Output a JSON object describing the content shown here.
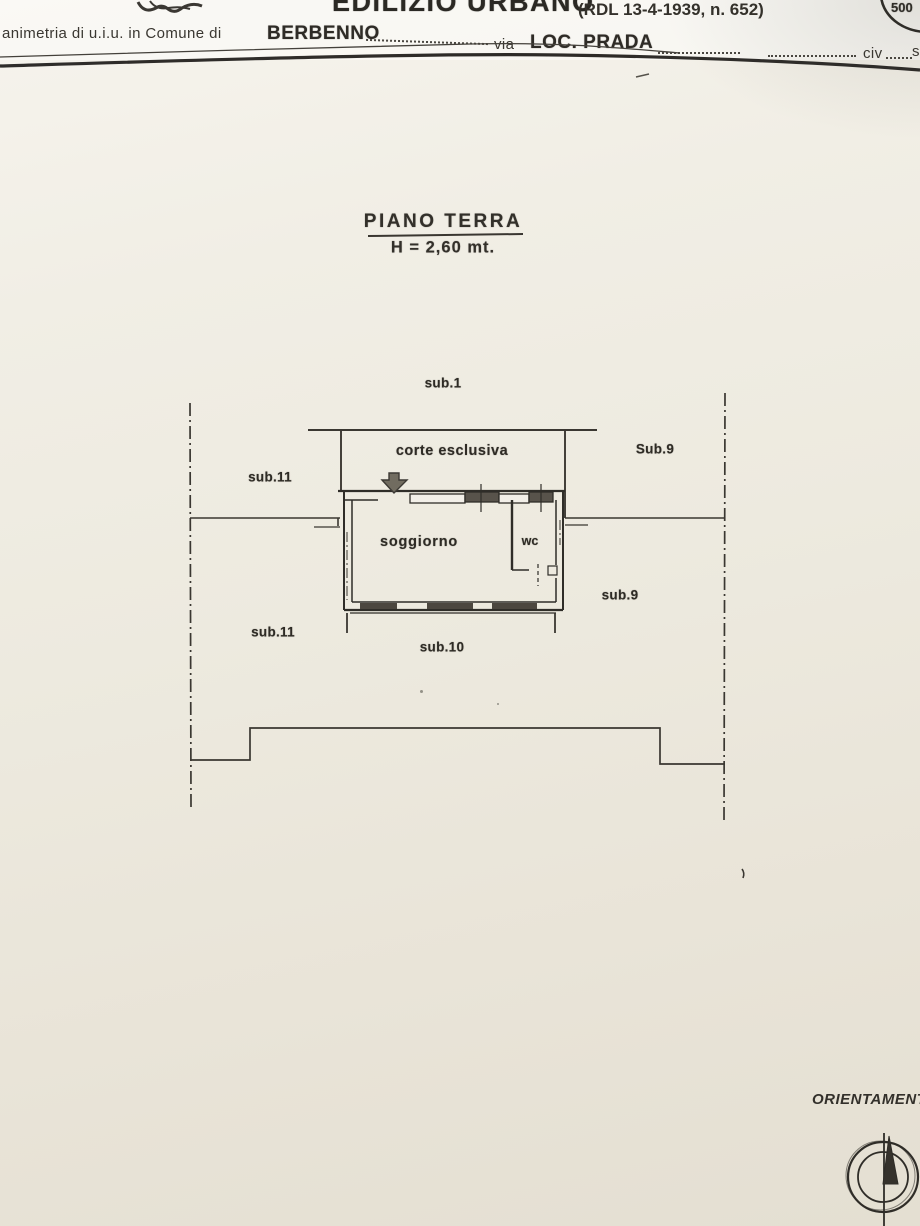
{
  "header": {
    "emblem_icon": "coat-of-arms-fragment",
    "title_partial": "EDILIZIO URBANO",
    "title_ref": "(RDL 13-4-1939, n. 652)",
    "stamp_value": "500",
    "form_line": {
      "prefix": "animetria di u.i.u. in Comune di",
      "comune": "BERBENNO",
      "via_label": "via",
      "via_value": "LOC. PRADA",
      "civ_label": "civ",
      "civ_partial": "s"
    }
  },
  "plan": {
    "title": "PIANO TERRA",
    "height_note": "H = 2,60 mt.",
    "labels": {
      "sub1": "sub.1",
      "corte": "corte esclusiva",
      "sub9_upper": "Sub.9",
      "sub11_upper": "sub.11",
      "soggiorno": "soggiorno",
      "wc": "wc",
      "sub9_lower": "sub.9",
      "sub11_lower": "sub.11",
      "sub10": "sub.10"
    }
  },
  "compass": {
    "label": "ORIENTAMENTO",
    "icon": "compass-north-needle"
  },
  "colors": {
    "paper": "#efece3",
    "ink": "#2f2d28",
    "window_fill": "#58534b"
  }
}
